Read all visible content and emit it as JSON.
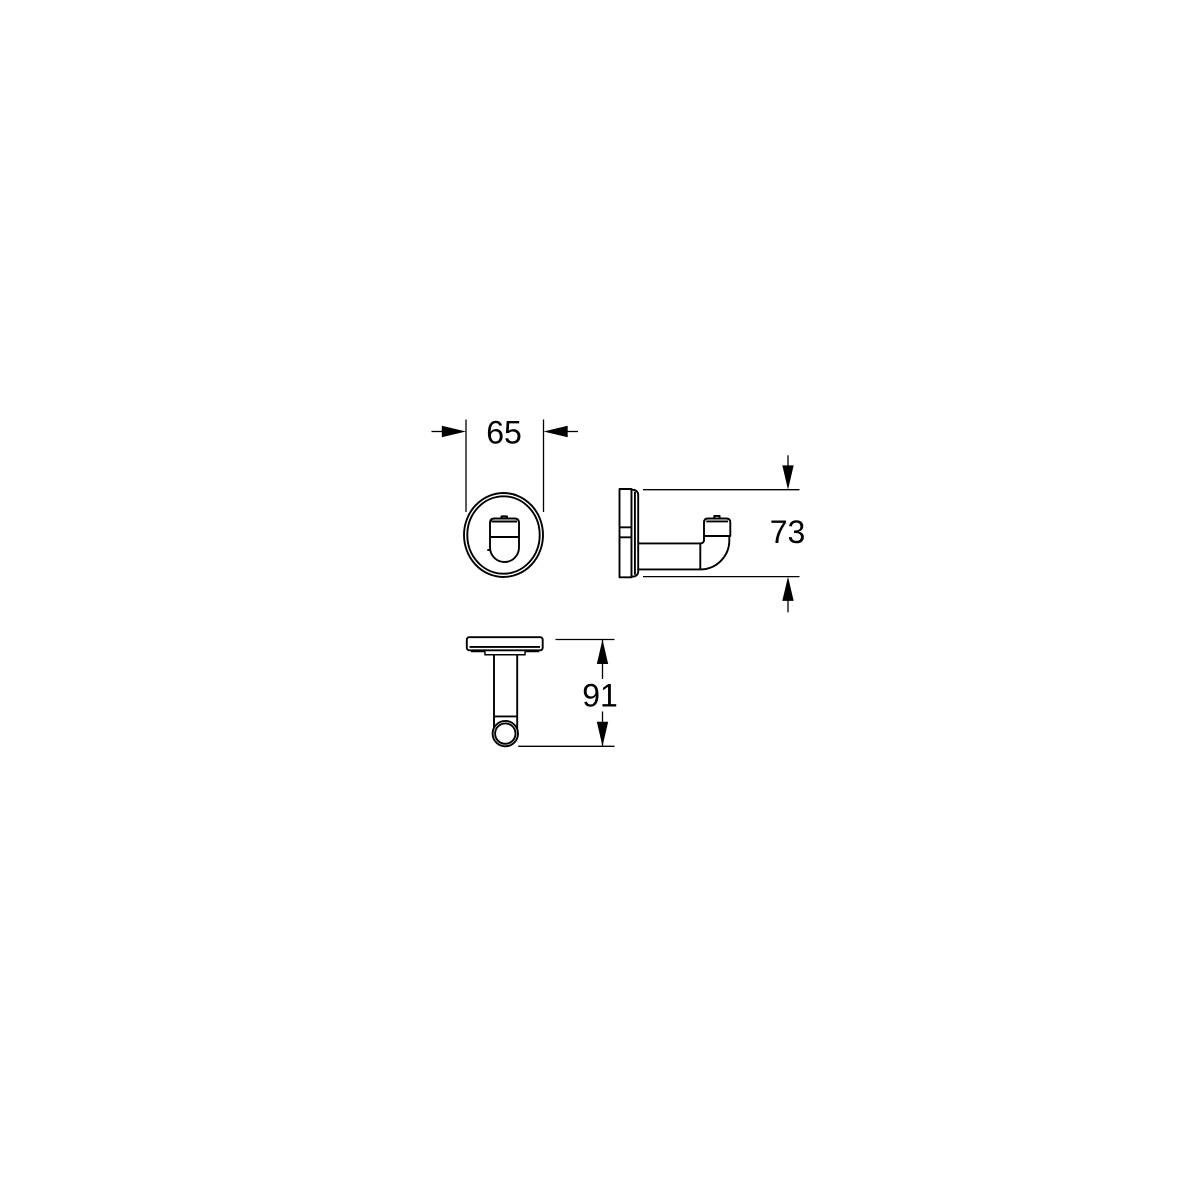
{
  "page": {
    "background_color": "#ffffff"
  },
  "drawing": {
    "line_color": "#000000",
    "kind": "dimensional drawing, wall hook, three views",
    "views": {
      "front": "front view",
      "side": "side view",
      "top": "top view"
    },
    "dimensions": {
      "width": {
        "label": "65"
      },
      "height": {
        "label": "73"
      },
      "depth": {
        "label": "91"
      }
    }
  }
}
